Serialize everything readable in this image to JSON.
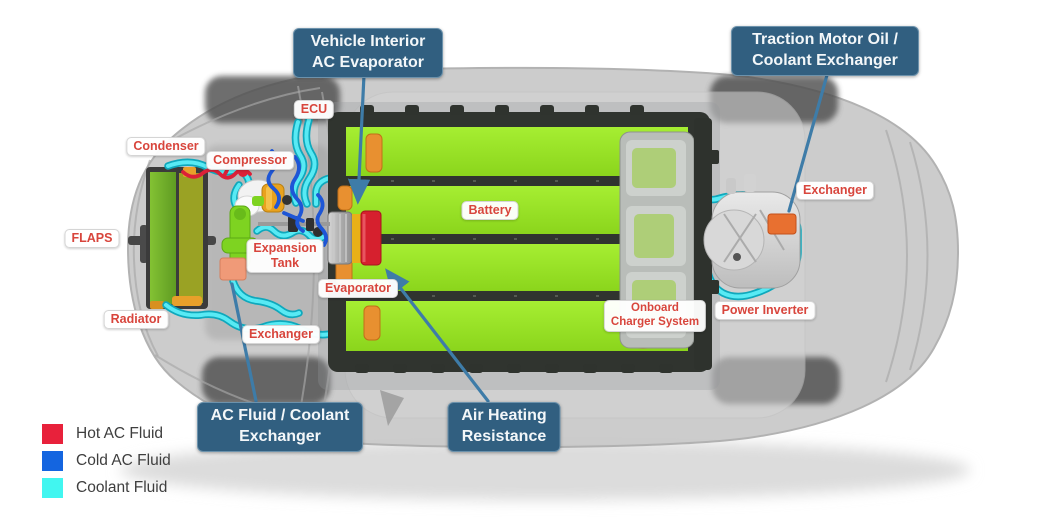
{
  "callouts": {
    "vehicle_interior": "Vehicle Interior\nAC Evaporator",
    "traction_motor": "Traction Motor Oil /\nCoolant Exchanger",
    "ac_fluid_coolant": "AC Fluid / Coolant\nExchanger",
    "air_heating": "Air Heating\nResistance"
  },
  "component_labels": {
    "ecu": "ECU",
    "condenser": "Condenser",
    "compressor": "Compressor",
    "flaps": "FLAPS",
    "expansion_tank": "Expansion\nTank",
    "radiator": "Radiator",
    "evaporator": "Evaporator",
    "exchanger_front": "Exchanger",
    "battery": "Battery",
    "onboard_charger": "Onboard\nCharger System",
    "power_inverter": "Power Inverter",
    "exchanger_rear": "Exchanger"
  },
  "legend": {
    "items": [
      {
        "label": "Hot AC Fluid",
        "color": "#E8213B"
      },
      {
        "label": "Cold AC Fluid",
        "color": "#1465E0"
      },
      {
        "label": "Coolant Fluid",
        "color": "#41F6F0"
      }
    ]
  },
  "colors": {
    "callout_bg": "#315F80",
    "component_label_text": "#D8453C",
    "coolant_pipe": "#58EAF4",
    "cold_ac_pipe": "#1E56D6",
    "hot_ac_pipe": "#DC2038",
    "battery_green": "#97E422",
    "leader_line": "#3E7CA8"
  }
}
